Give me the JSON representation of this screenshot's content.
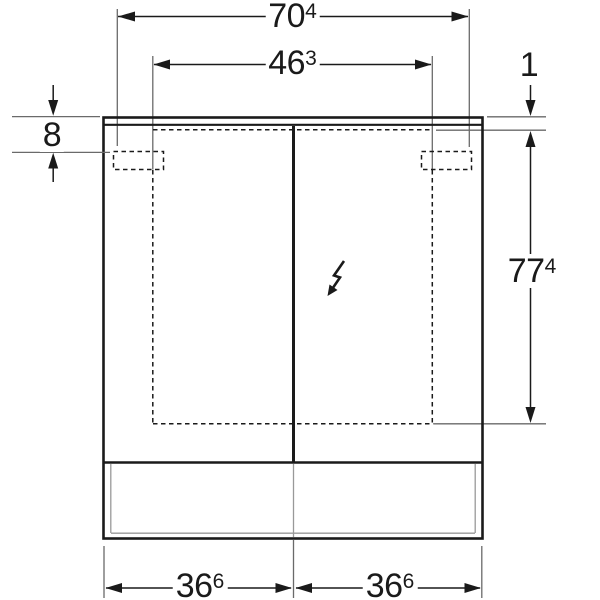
{
  "drawing": {
    "title": "mirror-cabinet-dimension-drawing",
    "dimensions": {
      "overall_width": {
        "value": "70",
        "sup": "4"
      },
      "fixing_width": {
        "value": "46",
        "sup": "3"
      },
      "lid_thickness": {
        "value": "1",
        "sup": ""
      },
      "top_offset": {
        "value": "8",
        "sup": ""
      },
      "height": {
        "value": "77",
        "sup": "4"
      },
      "door_width_left": {
        "value": "36",
        "sup": "6"
      },
      "door_width_right": {
        "value": "36",
        "sup": "6"
      }
    },
    "icons": {
      "electrical": "lightning-arrow"
    },
    "colors": {
      "line": "#1a1a1a",
      "extension_line": "#6a6a6a",
      "inner_panel_line": "#999999",
      "background": "#ffffff"
    }
  }
}
